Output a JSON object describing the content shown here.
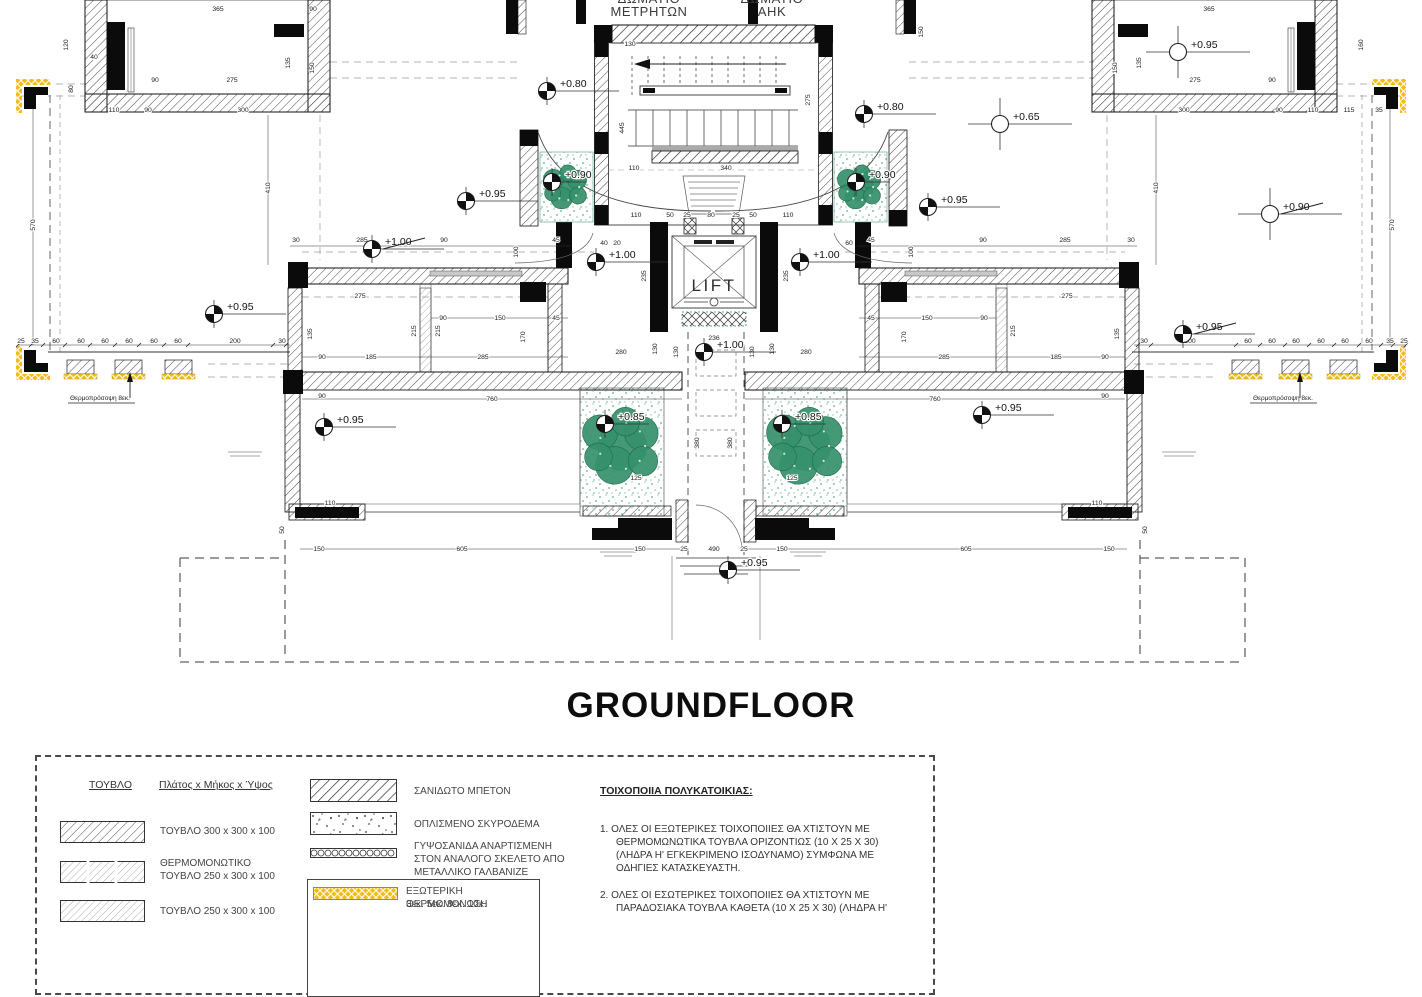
{
  "title": "GROUNDFLOOR",
  "plan": {
    "rooms": [
      {
        "id": "meter-room",
        "lines": [
          "ΔΩΜΑΤΙΟ",
          "ΜΕΤΡΗΤΩΝ"
        ],
        "x": 649,
        "y1": 3,
        "y2": 16
      },
      {
        "id": "ahk-room",
        "lines": [
          "ΔΩΜΑΤΙΟ",
          "ΑΗΚ"
        ],
        "x": 772,
        "y1": 3,
        "y2": 16
      }
    ],
    "lift": {
      "label": "LIFT",
      "x": 714,
      "y": 291
    },
    "annotations": [
      {
        "text": "Θερμοπρόσοψη 8εκ.",
        "x": 100,
        "y": 400
      },
      {
        "text": "Θερμοπρόσοψη 8εκ.",
        "x": 1283,
        "y": 400
      }
    ],
    "levels": [
      {
        "t": "+0.80",
        "x": 547,
        "y": 91,
        "m": "filled"
      },
      {
        "t": "+0.80",
        "x": 864,
        "y": 114,
        "m": "filled"
      },
      {
        "t": "+0.95",
        "x": 466,
        "y": 201,
        "m": "filled"
      },
      {
        "t": "+0.95",
        "x": 928,
        "y": 207,
        "m": "filled"
      },
      {
        "t": "+0.65",
        "x": 1000,
        "y": 124,
        "m": "open"
      },
      {
        "t": "+0.95",
        "x": 1178,
        "y": 52,
        "m": "open"
      },
      {
        "t": "+0.90",
        "x": 1270,
        "y": 214,
        "m": "open",
        "struck": true
      },
      {
        "t": "+1.00",
        "x": 372,
        "y": 249,
        "m": "filled",
        "struck": true
      },
      {
        "t": "+1.00",
        "x": 596,
        "y": 262,
        "m": "filled"
      },
      {
        "t": "+1.00",
        "x": 800,
        "y": 262,
        "m": "filled"
      },
      {
        "t": "+0.95",
        "x": 214,
        "y": 314,
        "m": "filled"
      },
      {
        "t": "+0.95",
        "x": 1183,
        "y": 334,
        "m": "filled",
        "struck": true
      },
      {
        "t": "+1.00",
        "x": 704,
        "y": 352,
        "m": "filled"
      },
      {
        "t": "+0.85",
        "x": 605,
        "y": 424,
        "m": "filled",
        "tail": 44
      },
      {
        "t": "+0.85",
        "x": 782,
        "y": 424,
        "m": "filled",
        "tail": 44
      },
      {
        "t": "+0.95",
        "x": 324,
        "y": 427,
        "m": "filled"
      },
      {
        "t": "+0.95",
        "x": 982,
        "y": 415,
        "m": "filled"
      },
      {
        "t": "+0.95",
        "x": 728,
        "y": 570,
        "m": "filled"
      },
      {
        "t": "+0.90",
        "x": 552,
        "y": 182,
        "m": "filled",
        "tail": 34
      },
      {
        "t": "+0.90",
        "x": 856,
        "y": 182,
        "m": "filled",
        "tail": 34
      }
    ],
    "trees": [
      {
        "x": 566,
        "y": 187,
        "r": 24
      },
      {
        "x": 860,
        "y": 187,
        "r": 24
      },
      {
        "x": 622,
        "y": 446,
        "r": 42
      },
      {
        "x": 806,
        "y": 446,
        "r": 42
      }
    ],
    "dims": [
      {
        "t": "365",
        "x": 218,
        "y": 9
      },
      {
        "t": "275",
        "x": 232,
        "y": 80
      },
      {
        "t": "90",
        "x": 155,
        "y": 80
      },
      {
        "t": "110",
        "x": 114,
        "y": 110
      },
      {
        "t": "90",
        "x": 148,
        "y": 110
      },
      {
        "t": "300",
        "x": 243,
        "y": 110
      },
      {
        "t": "120",
        "x": 66,
        "y": 45,
        "r": -90
      },
      {
        "t": "40",
        "x": 94,
        "y": 57
      },
      {
        "t": "80",
        "x": 71,
        "y": 89,
        "r": -90
      },
      {
        "t": "135",
        "x": 288,
        "y": 63,
        "r": -90
      },
      {
        "t": "150",
        "x": 312,
        "y": 68,
        "r": -90
      },
      {
        "t": "90",
        "x": 313,
        "y": 9
      },
      {
        "t": "365",
        "x": 1209,
        "y": 9
      },
      {
        "t": "275",
        "x": 1195,
        "y": 80
      },
      {
        "t": "90",
        "x": 1272,
        "y": 80
      },
      {
        "t": "110",
        "x": 1313,
        "y": 110
      },
      {
        "t": "90",
        "x": 1279,
        "y": 110
      },
      {
        "t": "300",
        "x": 1184,
        "y": 110
      },
      {
        "t": "160",
        "x": 1361,
        "y": 45,
        "r": -90
      },
      {
        "t": "135",
        "x": 1139,
        "y": 63,
        "r": -90
      },
      {
        "t": "150",
        "x": 1115,
        "y": 68,
        "r": -90
      },
      {
        "t": "115",
        "x": 1349,
        "y": 110
      },
      {
        "t": "35",
        "x": 1379,
        "y": 110
      },
      {
        "t": "570",
        "x": 33,
        "y": 225,
        "r": -90
      },
      {
        "t": "410",
        "x": 268,
        "y": 188,
        "r": -90
      },
      {
        "t": "25",
        "x": 21,
        "y": 341
      },
      {
        "t": "35",
        "x": 35,
        "y": 341
      },
      {
        "t": "60",
        "x": 56,
        "y": 341
      },
      {
        "t": "60",
        "x": 81,
        "y": 341
      },
      {
        "t": "60",
        "x": 105,
        "y": 341
      },
      {
        "t": "60",
        "x": 129,
        "y": 341
      },
      {
        "t": "60",
        "x": 154,
        "y": 341
      },
      {
        "t": "60",
        "x": 178,
        "y": 341
      },
      {
        "t": "200",
        "x": 235,
        "y": 341
      },
      {
        "t": "30",
        "x": 282,
        "y": 341
      },
      {
        "t": "570",
        "x": 1392,
        "y": 225,
        "r": -90
      },
      {
        "t": "410",
        "x": 1156,
        "y": 188,
        "r": -90
      },
      {
        "t": "30",
        "x": 1144,
        "y": 341
      },
      {
        "t": "200",
        "x": 1190,
        "y": 341
      },
      {
        "t": "60",
        "x": 1248,
        "y": 341
      },
      {
        "t": "60",
        "x": 1272,
        "y": 341
      },
      {
        "t": "60",
        "x": 1296,
        "y": 341
      },
      {
        "t": "60",
        "x": 1321,
        "y": 341
      },
      {
        "t": "60",
        "x": 1345,
        "y": 341
      },
      {
        "t": "60",
        "x": 1369,
        "y": 341
      },
      {
        "t": "35",
        "x": 1390,
        "y": 341
      },
      {
        "t": "25",
        "x": 1404,
        "y": 341
      },
      {
        "t": "130",
        "x": 630,
        "y": 44
      },
      {
        "t": "150",
        "x": 921,
        "y": 32,
        "r": -90
      },
      {
        "t": "445",
        "x": 622,
        "y": 128,
        "r": -90
      },
      {
        "t": "275",
        "x": 808,
        "y": 100,
        "r": -90
      },
      {
        "t": "110",
        "x": 634,
        "y": 168
      },
      {
        "t": "340",
        "x": 726,
        "y": 168
      },
      {
        "t": "110",
        "x": 636,
        "y": 215
      },
      {
        "t": "50",
        "x": 670,
        "y": 215
      },
      {
        "t": "25",
        "x": 687,
        "y": 215
      },
      {
        "t": "80",
        "x": 711,
        "y": 215
      },
      {
        "t": "25",
        "x": 736,
        "y": 215
      },
      {
        "t": "50",
        "x": 753,
        "y": 215
      },
      {
        "t": "110",
        "x": 788,
        "y": 215
      },
      {
        "t": "40",
        "x": 604,
        "y": 243
      },
      {
        "t": "20",
        "x": 617,
        "y": 243
      },
      {
        "t": "60",
        "x": 849,
        "y": 243
      },
      {
        "t": "235",
        "x": 644,
        "y": 276,
        "r": -90
      },
      {
        "t": "235",
        "x": 786,
        "y": 276,
        "r": -90
      },
      {
        "t": "236",
        "x": 714,
        "y": 338
      },
      {
        "t": "130",
        "x": 676,
        "y": 352,
        "r": -90
      },
      {
        "t": "130",
        "x": 752,
        "y": 352,
        "r": -90
      },
      {
        "t": "30",
        "x": 296,
        "y": 240
      },
      {
        "t": "285",
        "x": 362,
        "y": 240
      },
      {
        "t": "90",
        "x": 444,
        "y": 240
      },
      {
        "t": "100",
        "x": 516,
        "y": 252,
        "r": -90
      },
      {
        "t": "45",
        "x": 556,
        "y": 240
      },
      {
        "t": "275",
        "x": 360,
        "y": 296
      },
      {
        "t": "90",
        "x": 443,
        "y": 318
      },
      {
        "t": "150",
        "x": 500,
        "y": 318
      },
      {
        "t": "45",
        "x": 556,
        "y": 318
      },
      {
        "t": "135",
        "x": 310,
        "y": 334,
        "r": -90
      },
      {
        "t": "215",
        "x": 414,
        "y": 331,
        "r": -90
      },
      {
        "t": "215",
        "x": 438,
        "y": 331,
        "r": -90
      },
      {
        "t": "170",
        "x": 523,
        "y": 337,
        "r": -90
      },
      {
        "t": "90",
        "x": 322,
        "y": 357
      },
      {
        "t": "185",
        "x": 371,
        "y": 357
      },
      {
        "t": "285",
        "x": 483,
        "y": 357
      },
      {
        "t": "90",
        "x": 322,
        "y": 396
      },
      {
        "t": "760",
        "x": 492,
        "y": 399
      },
      {
        "t": "130",
        "x": 655,
        "y": 349,
        "r": -90
      },
      {
        "t": "280",
        "x": 621,
        "y": 352
      },
      {
        "t": "380",
        "x": 697,
        "y": 443,
        "r": -90
      },
      {
        "t": "30",
        "x": 1131,
        "y": 240
      },
      {
        "t": "285",
        "x": 1065,
        "y": 240
      },
      {
        "t": "90",
        "x": 983,
        "y": 240
      },
      {
        "t": "100",
        "x": 911,
        "y": 252,
        "r": -90
      },
      {
        "t": "45",
        "x": 871,
        "y": 240
      },
      {
        "t": "275",
        "x": 1067,
        "y": 296
      },
      {
        "t": "90",
        "x": 984,
        "y": 318
      },
      {
        "t": "150",
        "x": 927,
        "y": 318
      },
      {
        "t": "45",
        "x": 871,
        "y": 318
      },
      {
        "t": "135",
        "x": 1117,
        "y": 334,
        "r": -90
      },
      {
        "t": "215",
        "x": 1013,
        "y": 331,
        "r": -90
      },
      {
        "t": "170",
        "x": 904,
        "y": 337,
        "r": -90
      },
      {
        "t": "90",
        "x": 1105,
        "y": 357
      },
      {
        "t": "185",
        "x": 1056,
        "y": 357
      },
      {
        "t": "285",
        "x": 944,
        "y": 357
      },
      {
        "t": "90",
        "x": 1105,
        "y": 396
      },
      {
        "t": "760",
        "x": 935,
        "y": 399
      },
      {
        "t": "130",
        "x": 772,
        "y": 349,
        "r": -90
      },
      {
        "t": "280",
        "x": 806,
        "y": 352
      },
      {
        "t": "380",
        "x": 730,
        "y": 443,
        "r": -90
      },
      {
        "t": "125",
        "x": 636,
        "y": 478
      },
      {
        "t": "125",
        "x": 792,
        "y": 478
      },
      {
        "t": "110",
        "x": 330,
        "y": 503
      },
      {
        "t": "110",
        "x": 1097,
        "y": 503
      },
      {
        "t": "50",
        "x": 282,
        "y": 530,
        "r": -90
      },
      {
        "t": "50",
        "x": 1145,
        "y": 530,
        "r": -90
      },
      {
        "t": "150",
        "x": 319,
        "y": 549
      },
      {
        "t": "605",
        "x": 462,
        "y": 549
      },
      {
        "t": "150",
        "x": 640,
        "y": 549
      },
      {
        "t": "25",
        "x": 684,
        "y": 549
      },
      {
        "t": "490",
        "x": 714,
        "y": 549
      },
      {
        "t": "25",
        "x": 744,
        "y": 549
      },
      {
        "t": "150",
        "x": 782,
        "y": 549
      },
      {
        "t": "605",
        "x": 966,
        "y": 549
      },
      {
        "t": "150",
        "x": 1109,
        "y": 549
      }
    ]
  },
  "legend": {
    "bricks_header": "ΤΟΥΒΛΟ",
    "dims_header": "Πλάτος x Μήκος x Ύψος",
    "left_items": [
      {
        "label": "ΤΟΥΒΛΟ 300 x 300 x 100"
      },
      {
        "label": "ΘΕΡΜΟΜΟΝΩΤΙΚΟ",
        "label2": "ΤΟΥΒΛΟ 250 x 300 x 100"
      },
      {
        "label": "ΤΟΥΒΛΟ 250 x 300 x 100"
      }
    ],
    "right_items": [
      {
        "label": "ΣΑΝΙΔΩΤΟ ΜΠΕΤΟΝ"
      },
      {
        "label": "ΟΠΛΙΣΜΕΝΟ ΣΚΥΡΟΔΕΜΑ"
      },
      {
        "label": "ΓΥΨΟΣΑΝΙΔΑ ΑΝΑΡΤΙΣΜΕΝΗ",
        "label2": "ΣΤΟΝ ΑΝΑΛΟΓΟ ΣΚΕΛΕΤΟ ΑΠΟ",
        "label3": "ΜΕΤΑΛΛΙΚΟ ΓΑΛΒΑΝΙΖΕ"
      },
      {
        "label": "ΕΞΩΤΕΡΙΚΗ ΘΕΡΜΟΜΟΝΩΣΗ",
        "label2": "3εκ. 5εκ. 8εκ. 10κ."
      }
    ]
  },
  "masonry_notes": {
    "heading": "ΤΟΙΧΟΠΟΙΙΑ ΠΟΛΥΚΑΤΟΙΚΙΑΣ:",
    "item1_lines": [
      "1.  ΟΛΕΣ ΟΙ ΕΞΩΤΕΡΙΚΕΣ ΤΟΙΧΟΠΟΙΙΕΣ ΘΑ ΧΤΙΣΤΟΥΝ ΜΕ",
      "ΘΕΡΜΟΜΩΝΩΤΙΚΑ ΤΟΥΒΛΑ ΟΡΙΖΟΝΤΙΩΣ (10 Χ 25 Χ 30)",
      "(ΛΗΔΡΑ Η' ΕΓΚΕΚΡΙΜΕΝΟ ΙΣΟΔΥΝΑΜΟ) ΣΥΜΦΩΝΑ ΜΕ",
      "ΟΔΗΓΙΕΣ ΚΑΤΑΣΚΕΥΑΣΤΗ."
    ],
    "item2_lines": [
      "2.  ΟΛΕΣ ΟΙ ΕΣΩΤΕΡΙΚΕΣ ΤΟΙΧΟΠΟΙΙΕΣ ΘΑ ΧΤΙΣΤΟΥΝ ΜΕ",
      "ΠΑΡΑΔΟΣΙΑΚΑ ΤΟΥΒΛΑ ΚΑΘΕΤΑ (10 Χ 25 Χ 30) (ΛΗΔΡΑ Η'"
    ]
  },
  "colors": {
    "insulation_yellow": "#F2BC1B",
    "planting_green": "#35906B",
    "line_black": "#1a1a1a"
  }
}
